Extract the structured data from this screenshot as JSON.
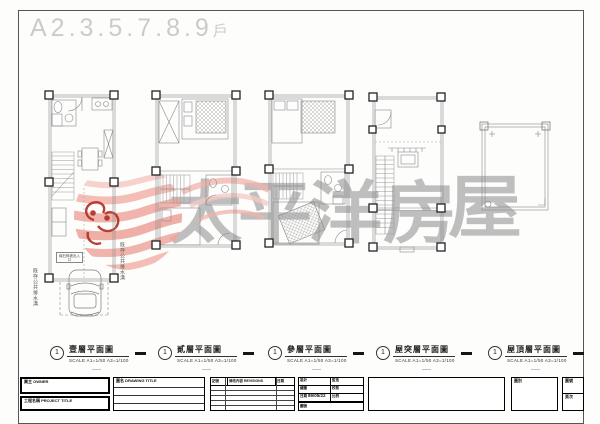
{
  "sheet": {
    "title": "A2.3.5.7.8.9",
    "title_suffix": "戶"
  },
  "watermark": {
    "brand": "太平洋房屋",
    "chars": [
      "太",
      "平",
      "洋",
      "房",
      "屋"
    ],
    "text_color": "#808080",
    "logo_pink": "#f0a9a1",
    "logo_dark_red": "#b5352c"
  },
  "plans": [
    {
      "ref": "1",
      "title": "壹層平面圖",
      "scale": "SCALE  A1=1/50   A3=1/100",
      "annotations": {
        "left": "既存公共排水溝",
        "right": "既存公共排水溝",
        "note": "緣石斜坡出入口"
      }
    },
    {
      "ref": "1",
      "title": "貳層平面圖",
      "scale": "SCALE  A1=1/50   A3=1/100"
    },
    {
      "ref": "1",
      "title": "參層平面圖",
      "scale": "SCALE  A1=1/50   A3=1/100"
    },
    {
      "ref": "1",
      "title": "屋突層平面圖",
      "scale": "SCALE  A1=1/50   A3=1/100"
    },
    {
      "ref": "1",
      "title": "屋頂層平面圖",
      "scale": "SCALE  A1=1/50   A3=1/100"
    }
  ],
  "titleblock": {
    "owner_label": "業主 OWNER",
    "project_label": "工程名稱 PROJECT TITLE",
    "drawing_label": "圖名 DRAWING TITLE",
    "revision": {
      "mark": "記號",
      "content": "修改內容 REVISIONS",
      "date": "日期"
    },
    "info": {
      "design": "設計",
      "supervise": "監造",
      "drawn": "繪圖",
      "checked": "校核",
      "date_label": "日期",
      "date": "89/05/22",
      "scale_label": "比例",
      "dwg_label": "圖號"
    },
    "site_label": "圖別",
    "sheet_no_label": "圖號",
    "page_label": "頁次"
  }
}
